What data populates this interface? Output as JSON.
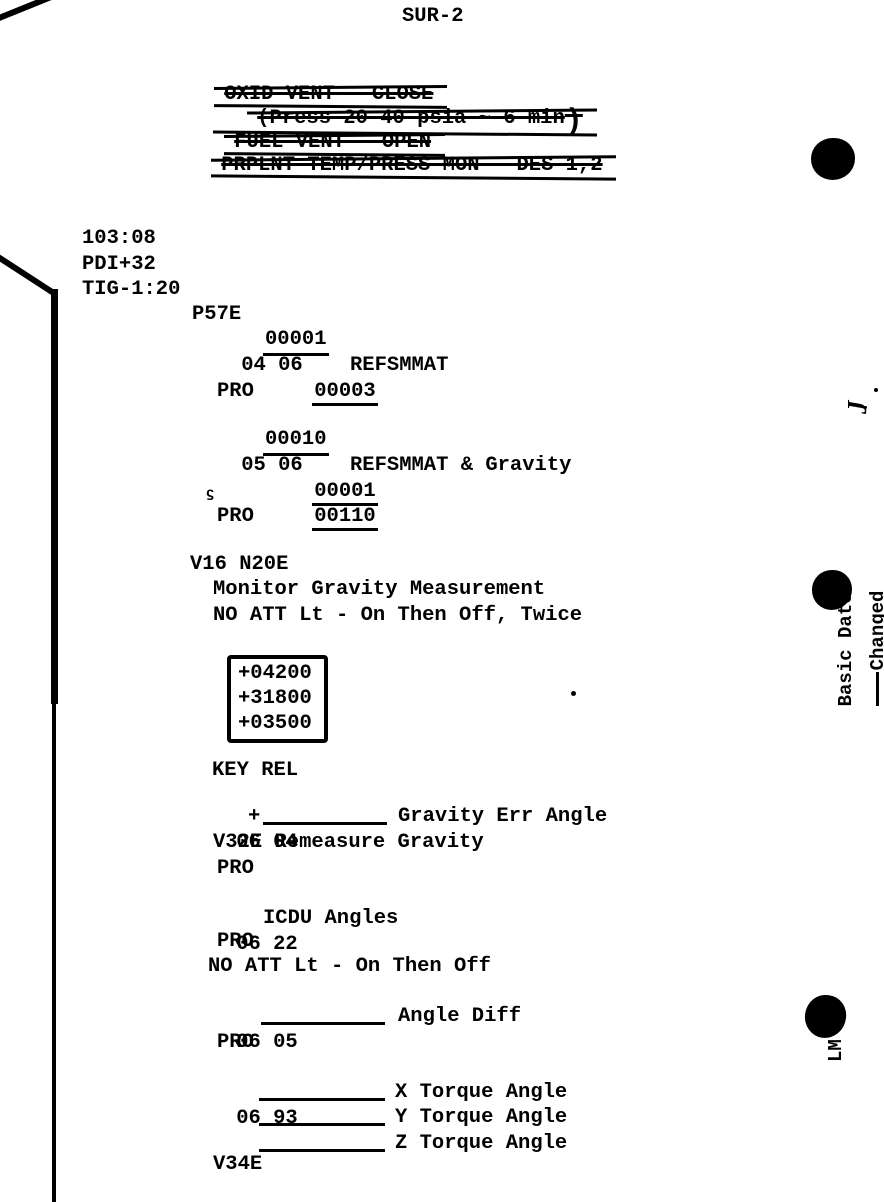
{
  "colors": {
    "ink": "#000000",
    "paper": "#ffffff"
  },
  "header": {
    "page_id": "SUR-2"
  },
  "deleted_steps": {
    "line1": "OXID VENT - CLOSE",
    "line2": "(Press 20-40 psia ~ 6 min",
    "line2_close": ")",
    "line3": "FUEL VENT - OPEN",
    "line4": "PRPLNT TEMP/PRESS MON - DES 1,2"
  },
  "timeline": {
    "get": "103:08",
    "pdi": "PDI+32",
    "tig": "TIG-1:20"
  },
  "common": {
    "pro": "PRO"
  },
  "p57": {
    "program": "P57E",
    "vn1": "04 06",
    "vn1_r1": "00001",
    "vn1_r2": "00003",
    "vn1_r2_label": "REFSMMAT",
    "vn2": "05 06",
    "vn2_r1": "00010",
    "vn2_r2": "00001",
    "vn2_r2_label": "REFSMMAT & Gravity",
    "vn2_r3": "00110",
    "stray_mark": "ϛ"
  },
  "v16": {
    "cmd": "V16 N20E",
    "note1": "Monitor Gravity Measurement",
    "note2": "NO ATT Lt - On Then Off, Twice",
    "gravity_values": [
      "+04200",
      "+31800",
      "+03500"
    ],
    "key_rel": "KEY REL"
  },
  "n04": {
    "vn": "06 04",
    "sign": "+",
    "label": "Gravity Err Angle",
    "remeasure": "V32E Remeasure Gravity"
  },
  "n22": {
    "vn": "06 22",
    "label": "ICDU Angles",
    "note": "NO ATT Lt - On Then Off"
  },
  "n05": {
    "vn": "06 05",
    "label": "Angle Diff"
  },
  "n93": {
    "vn": "06 93",
    "label_x": "X Torque Angle",
    "label_y": "Y Torque Angle",
    "label_z": "Z Torque Angle",
    "cmd": "V34E"
  },
  "margin": {
    "basic_date_label": "Basic Date",
    "basic_date_value": "June 16, 1969",
    "changed_label": "Changed",
    "changed_value": "July 12",
    "changed_year": " 1969",
    "handwritten_mark": "J",
    "lm_label": "LM"
  }
}
